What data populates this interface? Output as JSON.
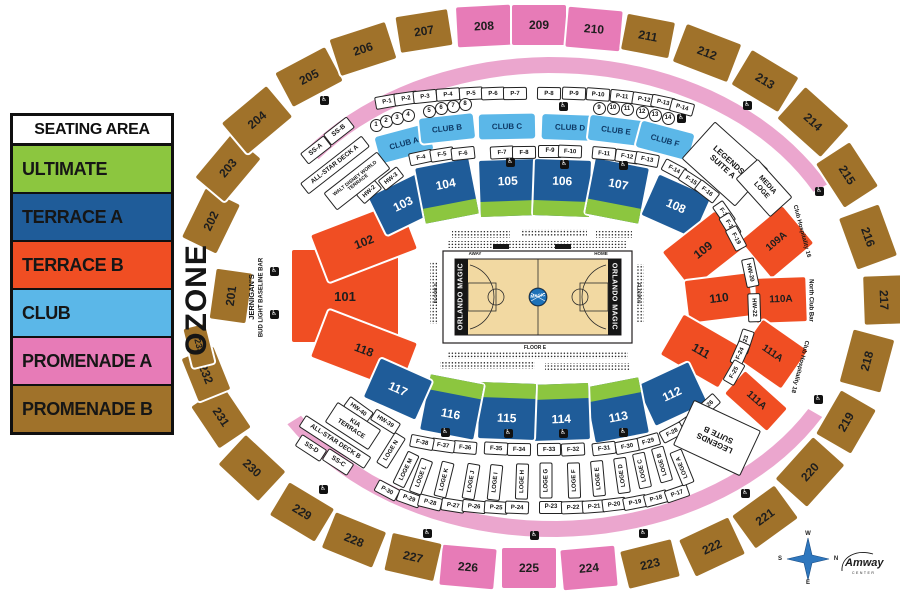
{
  "legend": {
    "title": "SEATING AREA",
    "items": [
      {
        "label": "ULTIMATE",
        "color": "#8CC63F"
      },
      {
        "label": "TERRACE A",
        "color": "#1F5C99"
      },
      {
        "label": "TERRACE B",
        "color": "#F04E23"
      },
      {
        "label": "CLUB",
        "color": "#5BB7E8"
      },
      {
        "label": "PROMENADE A",
        "color": "#E77BB7"
      },
      {
        "label": "PROMENADE B",
        "color": "#A0722A"
      }
    ]
  },
  "colors": {
    "ULTIMATE": "#8CC63F",
    "TERRACE_A": "#1F5C99",
    "TERRACE_B": "#F04E23",
    "CLUB": "#5BB7E8",
    "PROMENADE_A": "#E77BB7",
    "PROMENADE_B": "#A0722A",
    "RING_PINK": "#EBA6CE",
    "COURT": "#F2D9A2",
    "LOGO_BLUE": "#1E72B8",
    "COMPASS_BLUE": "#2E77BE"
  },
  "sections": [
    {
      "label": "201",
      "cat": "PROMENADE_B",
      "x": 231,
      "y": 296,
      "w": 50,
      "h": 36,
      "r": -82
    },
    {
      "label": "202",
      "cat": "PROMENADE_B",
      "x": 211,
      "y": 221,
      "w": 54,
      "h": 38,
      "r": -64
    },
    {
      "label": "203",
      "cat": "PROMENADE_B",
      "x": 228,
      "y": 168,
      "w": 56,
      "h": 38,
      "r": -50
    },
    {
      "label": "204",
      "cat": "PROMENADE_B",
      "x": 257,
      "y": 120,
      "w": 58,
      "h": 40,
      "r": -40
    },
    {
      "label": "205",
      "cat": "PROMENADE_B",
      "x": 309,
      "y": 77,
      "w": 56,
      "h": 38,
      "r": -28
    },
    {
      "label": "206",
      "cat": "PROMENADE_B",
      "x": 363,
      "y": 49,
      "w": 58,
      "h": 38,
      "r": -18
    },
    {
      "label": "207",
      "cat": "PROMENADE_B",
      "x": 424,
      "y": 31,
      "w": 52,
      "h": 36,
      "r": -9
    },
    {
      "label": "208",
      "cat": "PROMENADE_A",
      "x": 484,
      "y": 26,
      "w": 54,
      "h": 40,
      "r": -3
    },
    {
      "label": "209",
      "cat": "PROMENADE_A",
      "x": 539,
      "y": 25,
      "w": 54,
      "h": 40,
      "r": 0
    },
    {
      "label": "210",
      "cat": "PROMENADE_A",
      "x": 594,
      "y": 29,
      "w": 54,
      "h": 40,
      "r": 5
    },
    {
      "label": "211",
      "cat": "PROMENADE_B",
      "x": 648,
      "y": 36,
      "w": 48,
      "h": 36,
      "r": 11
    },
    {
      "label": "212",
      "cat": "PROMENADE_B",
      "x": 707,
      "y": 53,
      "w": 58,
      "h": 40,
      "r": 21
    },
    {
      "label": "213",
      "cat": "PROMENADE_B",
      "x": 765,
      "y": 81,
      "w": 54,
      "h": 40,
      "r": 31
    },
    {
      "label": "214",
      "cat": "PROMENADE_B",
      "x": 813,
      "y": 122,
      "w": 58,
      "h": 42,
      "r": 42
    },
    {
      "label": "215",
      "cat": "PROMENADE_B",
      "x": 847,
      "y": 175,
      "w": 52,
      "h": 40,
      "r": 57
    },
    {
      "label": "216",
      "cat": "PROMENADE_B",
      "x": 868,
      "y": 237,
      "w": 54,
      "h": 42,
      "r": 70
    },
    {
      "label": "217",
      "cat": "PROMENADE_B",
      "x": 884,
      "y": 300,
      "w": 48,
      "h": 40,
      "r": 88
    },
    {
      "label": "218",
      "cat": "PROMENADE_B",
      "x": 867,
      "y": 361,
      "w": 54,
      "h": 42,
      "r": -75
    },
    {
      "label": "219",
      "cat": "PROMENADE_B",
      "x": 846,
      "y": 422,
      "w": 50,
      "h": 40,
      "r": -60
    },
    {
      "label": "220",
      "cat": "PROMENADE_B",
      "x": 810,
      "y": 472,
      "w": 56,
      "h": 42,
      "r": -48
    },
    {
      "label": "221",
      "cat": "PROMENADE_B",
      "x": 765,
      "y": 517,
      "w": 52,
      "h": 40,
      "r": -36
    },
    {
      "label": "222",
      "cat": "PROMENADE_B",
      "x": 712,
      "y": 547,
      "w": 54,
      "h": 40,
      "r": -25
    },
    {
      "label": "223",
      "cat": "PROMENADE_B",
      "x": 650,
      "y": 564,
      "w": 52,
      "h": 38,
      "r": -14
    },
    {
      "label": "224",
      "cat": "PROMENADE_A",
      "x": 589,
      "y": 568,
      "w": 54,
      "h": 40,
      "r": -5
    },
    {
      "label": "225",
      "cat": "PROMENADE_A",
      "x": 529,
      "y": 568,
      "w": 54,
      "h": 40,
      "r": 0
    },
    {
      "label": "226",
      "cat": "PROMENADE_A",
      "x": 468,
      "y": 567,
      "w": 54,
      "h": 40,
      "r": 5
    },
    {
      "label": "227",
      "cat": "PROMENADE_B",
      "x": 413,
      "y": 557,
      "w": 50,
      "h": 38,
      "r": 13
    },
    {
      "label": "228",
      "cat": "PROMENADE_B",
      "x": 354,
      "y": 540,
      "w": 54,
      "h": 38,
      "r": 22
    },
    {
      "label": "229",
      "cat": "PROMENADE_B",
      "x": 302,
      "y": 512,
      "w": 52,
      "h": 38,
      "r": 31
    },
    {
      "label": "230",
      "cat": "PROMENADE_B",
      "x": 252,
      "y": 468,
      "w": 54,
      "h": 40,
      "r": 43
    },
    {
      "label": "231",
      "cat": "PROMENADE_B",
      "x": 221,
      "y": 417,
      "w": 50,
      "h": 38,
      "r": 56
    },
    {
      "label": "232",
      "cat": "PROMENADE_B",
      "x": 206,
      "y": 374,
      "w": 46,
      "h": 34,
      "r": 68
    },
    {
      "label": "233",
      "cat": "PROMENADE_B",
      "x": 199,
      "y": 346,
      "w": 40,
      "h": 22,
      "r": 76,
      "fs": 9
    },
    {
      "label": "101",
      "cat": "TERRACE_B",
      "x": 345,
      "y": 296,
      "w": 106,
      "h": 92,
      "r": 0,
      "fs": 13
    },
    {
      "label": "102",
      "cat": "TERRACE_B",
      "x": 364,
      "y": 242,
      "w": 94,
      "h": 50,
      "r": -21
    },
    {
      "label": "118",
      "cat": "TERRACE_B",
      "x": 364,
      "y": 350,
      "w": 94,
      "h": 50,
      "r": 21
    },
    {
      "label": "103",
      "cat": "TERRACE_A",
      "x": 403,
      "y": 204,
      "w": 56,
      "h": 42,
      "r": -26
    },
    {
      "label": "104",
      "cat": "TERRACE_A",
      "x": 447,
      "y": 191,
      "w": 54,
      "h": 56,
      "r": -11,
      "green": "bottom"
    },
    {
      "label": "105",
      "cat": "TERRACE_A",
      "x": 508,
      "y": 188,
      "w": 56,
      "h": 56,
      "r": -2,
      "green": "bottom"
    },
    {
      "label": "106",
      "cat": "TERRACE_A",
      "x": 562,
      "y": 188,
      "w": 56,
      "h": 56,
      "r": 2,
      "green": "bottom"
    },
    {
      "label": "107",
      "cat": "TERRACE_A",
      "x": 617,
      "y": 191,
      "w": 54,
      "h": 56,
      "r": 11,
      "green": "bottom"
    },
    {
      "label": "108",
      "cat": "TERRACE_A",
      "x": 676,
      "y": 206,
      "w": 56,
      "h": 44,
      "r": 24
    },
    {
      "label": "109",
      "cat": "TERRACE_B",
      "x": 703,
      "y": 250,
      "w": 66,
      "h": 46,
      "r": -38
    },
    {
      "label": "109A",
      "cat": "TERRACE_B",
      "x": 777,
      "y": 242,
      "w": 54,
      "h": 48,
      "r": -40,
      "fs": 10
    },
    {
      "label": "110",
      "cat": "TERRACE_B",
      "x": 719,
      "y": 298,
      "w": 64,
      "h": 42,
      "r": -7
    },
    {
      "label": "110A",
      "cat": "TERRACE_B",
      "x": 781,
      "y": 300,
      "w": 50,
      "h": 44,
      "r": -2,
      "fs": 10
    },
    {
      "label": "111",
      "cat": "TERRACE_B",
      "x": 701,
      "y": 351,
      "w": 66,
      "h": 46,
      "r": 30
    },
    {
      "label": "111A",
      "cat": "TERRACE_B",
      "x": 772,
      "y": 354,
      "w": 54,
      "h": 46,
      "r": 35,
      "fs": 10
    },
    {
      "label": "111A",
      "cat": "TERRACE_B",
      "x": 756,
      "y": 401,
      "w": 56,
      "h": 30,
      "r": 42,
      "fs": 10
    },
    {
      "label": "112",
      "cat": "TERRACE_A",
      "x": 672,
      "y": 394,
      "w": 56,
      "h": 44,
      "r": -25
    },
    {
      "label": "113",
      "cat": "TERRACE_A",
      "x": 617,
      "y": 410,
      "w": 54,
      "h": 56,
      "r": -11,
      "green": "top"
    },
    {
      "label": "114",
      "cat": "TERRACE_A",
      "x": 561,
      "y": 412,
      "w": 56,
      "h": 56,
      "r": -2,
      "green": "top"
    },
    {
      "label": "115",
      "cat": "TERRACE_A",
      "x": 507,
      "y": 411,
      "w": 56,
      "h": 56,
      "r": 2,
      "green": "top"
    },
    {
      "label": "116",
      "cat": "TERRACE_A",
      "x": 452,
      "y": 407,
      "w": 54,
      "h": 56,
      "r": 11,
      "green": "top"
    },
    {
      "label": "117",
      "cat": "TERRACE_A",
      "x": 398,
      "y": 389,
      "w": 56,
      "h": 42,
      "r": 24
    }
  ],
  "clubs": [
    {
      "label": "CLUB A",
      "x": 404,
      "y": 143,
      "w": 54,
      "h": 27,
      "r": -15
    },
    {
      "label": "CLUB B",
      "x": 447,
      "y": 128,
      "w": 54,
      "h": 25,
      "r": -6
    },
    {
      "label": "CLUB C",
      "x": 507,
      "y": 126,
      "w": 56,
      "h": 25,
      "r": -1
    },
    {
      "label": "CLUB D",
      "x": 570,
      "y": 127,
      "w": 56,
      "h": 25,
      "r": 2
    },
    {
      "label": "CLUB E",
      "x": 616,
      "y": 130,
      "w": 54,
      "h": 25,
      "r": 7
    },
    {
      "label": "CLUB F",
      "x": 665,
      "y": 140,
      "w": 54,
      "h": 27,
      "r": 15
    }
  ],
  "portal_boxes": [
    [
      "P-1",
      386,
      100,
      -10
    ],
    [
      "P-2",
      405,
      97,
      -8
    ],
    [
      "P-3",
      424,
      95,
      -6
    ],
    [
      "P-4",
      447,
      93,
      -4
    ],
    [
      "P-5",
      470,
      92,
      -3
    ],
    [
      "P-6",
      492,
      92,
      -2
    ],
    [
      "P-7",
      514,
      92,
      -1
    ],
    [
      "P-8",
      548,
      92,
      1
    ],
    [
      "P-9",
      573,
      92,
      2
    ],
    [
      "P-10",
      597,
      93,
      4
    ],
    [
      "P-11",
      621,
      95,
      6
    ],
    [
      "P-12",
      643,
      98,
      9
    ],
    [
      "P-13",
      662,
      101,
      12
    ],
    [
      "P-14",
      681,
      106,
      15
    ],
    [
      "HW-2",
      368,
      190,
      -42
    ],
    [
      "HW-3",
      390,
      177,
      -38
    ],
    [
      "F-4",
      420,
      156,
      -12
    ],
    [
      "F-5",
      441,
      153,
      -9
    ],
    [
      "F-6",
      462,
      152,
      -6
    ],
    [
      "F-7",
      501,
      151,
      -3
    ],
    [
      "F-8",
      523,
      151,
      -1
    ],
    [
      "F-9",
      549,
      150,
      0
    ],
    [
      "F-10",
      569,
      150,
      2
    ],
    [
      "F-11",
      603,
      152,
      5
    ],
    [
      "F-12",
      626,
      155,
      8
    ],
    [
      "F-13",
      646,
      158,
      11
    ],
    [
      "F-14",
      673,
      168,
      28
    ],
    [
      "F-15",
      690,
      179,
      33
    ],
    [
      "F-16",
      706,
      190,
      38
    ],
    [
      "F-17",
      723,
      212,
      55
    ],
    [
      "F-18",
      729,
      224,
      58
    ],
    [
      "F-19",
      735,
      237,
      62
    ],
    [
      "HW-20",
      749,
      271,
      78
    ],
    [
      "HW-22",
      753,
      306,
      88
    ],
    [
      "F-23",
      744,
      340,
      -72
    ],
    [
      "F-24",
      739,
      352,
      -66
    ],
    [
      "F-25",
      733,
      371,
      -60
    ],
    [
      "F-26",
      707,
      404,
      -42
    ],
    [
      "F-27",
      689,
      420,
      -35
    ],
    [
      "F-28",
      671,
      431,
      -28
    ],
    [
      "F-29",
      647,
      440,
      -16
    ],
    [
      "F-30",
      626,
      445,
      -11
    ],
    [
      "F-31",
      603,
      447,
      -7
    ],
    [
      "F-32",
      572,
      448,
      -3
    ],
    [
      "F-33",
      548,
      448,
      -1
    ],
    [
      "F-34",
      518,
      448,
      1
    ],
    [
      "F-35",
      495,
      447,
      3
    ],
    [
      "F-36",
      464,
      446,
      5
    ],
    [
      "F-37",
      442,
      444,
      8
    ],
    [
      "F-38",
      421,
      441,
      11
    ],
    [
      "HW-39",
      384,
      420,
      32
    ],
    [
      "HW-40",
      357,
      408,
      36
    ],
    [
      "P-30",
      386,
      489,
      28
    ],
    [
      "P-29",
      408,
      497,
      20
    ],
    [
      "P-28",
      429,
      501,
      14
    ],
    [
      "P-27",
      452,
      504,
      9
    ],
    [
      "P-26",
      473,
      505,
      6
    ],
    [
      "P-25",
      495,
      506,
      4
    ],
    [
      "P-24",
      516,
      506,
      2
    ],
    [
      "P-23",
      550,
      506,
      0
    ],
    [
      "P-22",
      572,
      506,
      -2
    ],
    [
      "P-21",
      593,
      505,
      -4
    ],
    [
      "P-20",
      613,
      503,
      -7
    ],
    [
      "P-19",
      634,
      501,
      -11
    ],
    [
      "P-18",
      655,
      497,
      -15
    ],
    [
      "P-17",
      676,
      492,
      -19
    ]
  ],
  "loge_boxes": [
    [
      "LOGE N",
      390,
      449,
      -58
    ],
    [
      "LOGE M",
      405,
      468,
      -64
    ],
    [
      "LOGE L",
      420,
      475,
      -70
    ],
    [
      "LOGE K",
      443,
      478,
      -76
    ],
    [
      "LOGE J",
      470,
      480,
      -80
    ],
    [
      "LOGE I",
      494,
      481,
      -84
    ],
    [
      "LOGE H",
      521,
      480,
      -88
    ],
    [
      "LOGE G",
      545,
      479,
      -90
    ],
    [
      "LOGE F",
      573,
      479,
      -92
    ],
    [
      "LOGE E",
      597,
      477,
      -95
    ],
    [
      "LOGE D",
      621,
      474,
      -98
    ],
    [
      "LOGE C",
      641,
      469,
      -102
    ],
    [
      "LOGE B",
      661,
      463,
      -106
    ],
    [
      "LOGE A",
      681,
      466,
      -112
    ]
  ],
  "suite_circles": [
    [
      "1",
      375,
      124
    ],
    [
      "2",
      385,
      120
    ],
    [
      "3",
      396,
      117
    ],
    [
      "4",
      407,
      114
    ],
    [
      "5",
      428,
      110
    ],
    [
      "6",
      440,
      107
    ],
    [
      "7",
      452,
      105
    ],
    [
      "8",
      464,
      103
    ],
    [
      "9",
      598,
      107
    ],
    [
      "10",
      612,
      107
    ],
    [
      "11",
      626,
      108
    ],
    [
      "12",
      641,
      111
    ],
    [
      "13",
      654,
      114
    ],
    [
      "14",
      667,
      117
    ]
  ],
  "wheelchair_positions": [
    [
      324,
      100
    ],
    [
      563,
      106
    ],
    [
      681,
      118
    ],
    [
      747,
      105
    ],
    [
      510,
      162
    ],
    [
      564,
      164
    ],
    [
      623,
      165
    ],
    [
      819,
      191
    ],
    [
      274,
      271
    ],
    [
      274,
      314
    ],
    [
      818,
      399
    ],
    [
      745,
      493
    ],
    [
      323,
      489
    ],
    [
      427,
      533
    ],
    [
      534,
      535
    ],
    [
      643,
      533
    ],
    [
      445,
      432
    ],
    [
      508,
      433
    ],
    [
      563,
      433
    ],
    [
      623,
      432
    ]
  ],
  "areas": [
    {
      "lines": [
        "LEGENDS",
        "SUITE A"
      ],
      "x": 724,
      "y": 163,
      "w": 70,
      "h": 48,
      "r": 42,
      "fs": 8,
      "box": true
    },
    {
      "lines": [
        "MEDIA",
        "LOGE"
      ],
      "x": 763,
      "y": 187,
      "w": 50,
      "h": 28,
      "r": 48,
      "fs": 7,
      "box": true
    },
    {
      "lines": [
        "LEGENDS",
        "SUITE B"
      ],
      "x": 716,
      "y": 437,
      "w": 72,
      "h": 48,
      "r": 205,
      "fs": 8,
      "box": true
    },
    {
      "lines": [
        "KIA",
        "TERRACE"
      ],
      "x": 352,
      "y": 425,
      "w": 50,
      "h": 22,
      "r": 33,
      "fs": 6.5,
      "box": true
    },
    {
      "lines": [
        "ALL-STAR DECK B"
      ],
      "x": 334,
      "y": 441,
      "w": 76,
      "h": 12,
      "r": 33,
      "fs": 6.5,
      "box": true
    },
    {
      "lines": [
        "SS-D"
      ],
      "x": 310,
      "y": 447,
      "w": 28,
      "h": 12,
      "r": 33,
      "fs": 6.5,
      "box": true
    },
    {
      "lines": [
        "SS-C"
      ],
      "x": 337,
      "y": 461,
      "w": 28,
      "h": 12,
      "r": 33,
      "fs": 6.5,
      "box": true
    },
    {
      "lines": [
        "SS-A"
      ],
      "x": 315,
      "y": 149,
      "w": 28,
      "h": 12,
      "r": -38,
      "fs": 6.5,
      "box": true
    },
    {
      "lines": [
        "SS-B"
      ],
      "x": 338,
      "y": 130,
      "w": 28,
      "h": 12,
      "r": -38,
      "fs": 6.5,
      "box": true
    },
    {
      "lines": [
        "ALL-STAR DECK A"
      ],
      "x": 334,
      "y": 164,
      "w": 76,
      "h": 12,
      "r": -38,
      "fs": 6.5,
      "box": true
    },
    {
      "lines": [
        "WALT DISNEY WORLD",
        "TERRACE"
      ],
      "x": 356,
      "y": 180,
      "w": 66,
      "h": 20,
      "r": -38,
      "fs": 5,
      "box": true
    },
    {
      "lines": [
        "OZONE"
      ],
      "x": 197,
      "y": 300,
      "w": 150,
      "h": 36,
      "r": -90,
      "fs": 30,
      "box": false,
      "ls": 1
    },
    {
      "lines": [
        "JERNIGAN'S"
      ],
      "x": 252,
      "y": 297,
      "w": 100,
      "h": 10,
      "r": -90,
      "fs": 7.5,
      "box": false
    },
    {
      "lines": [
        "BUD LIGHT BASELINE BAR"
      ],
      "x": 262,
      "y": 297,
      "w": 110,
      "h": 9,
      "r": -90,
      "fs": 6,
      "box": false
    },
    {
      "lines": [
        "Club Hospitality 16"
      ],
      "x": 801,
      "y": 231,
      "w": 84,
      "h": 9,
      "r": 75,
      "fs": 6,
      "box": false
    },
    {
      "lines": [
        "North Club Bar"
      ],
      "x": 810,
      "y": 300,
      "w": 70,
      "h": 9,
      "r": 90,
      "fs": 6,
      "box": false
    },
    {
      "lines": [
        "Club Hospitality 18"
      ],
      "x": 799,
      "y": 366,
      "w": 84,
      "h": 9,
      "r": 105,
      "fs": 6,
      "box": false
    }
  ],
  "court": {
    "away": "AWAY",
    "home": "HOME",
    "floor_s": "FLOOR S",
    "floor_n": "FLOOR N",
    "floor_e": "FLOOR E",
    "endzone_text": "ORLANDO MAGIC",
    "logo_text": "MAGIC"
  },
  "compass": {
    "top": "W",
    "right": "N",
    "bottom": "E",
    "left": "S"
  },
  "branding": {
    "name": "Amway",
    "sub": "CENTER"
  }
}
